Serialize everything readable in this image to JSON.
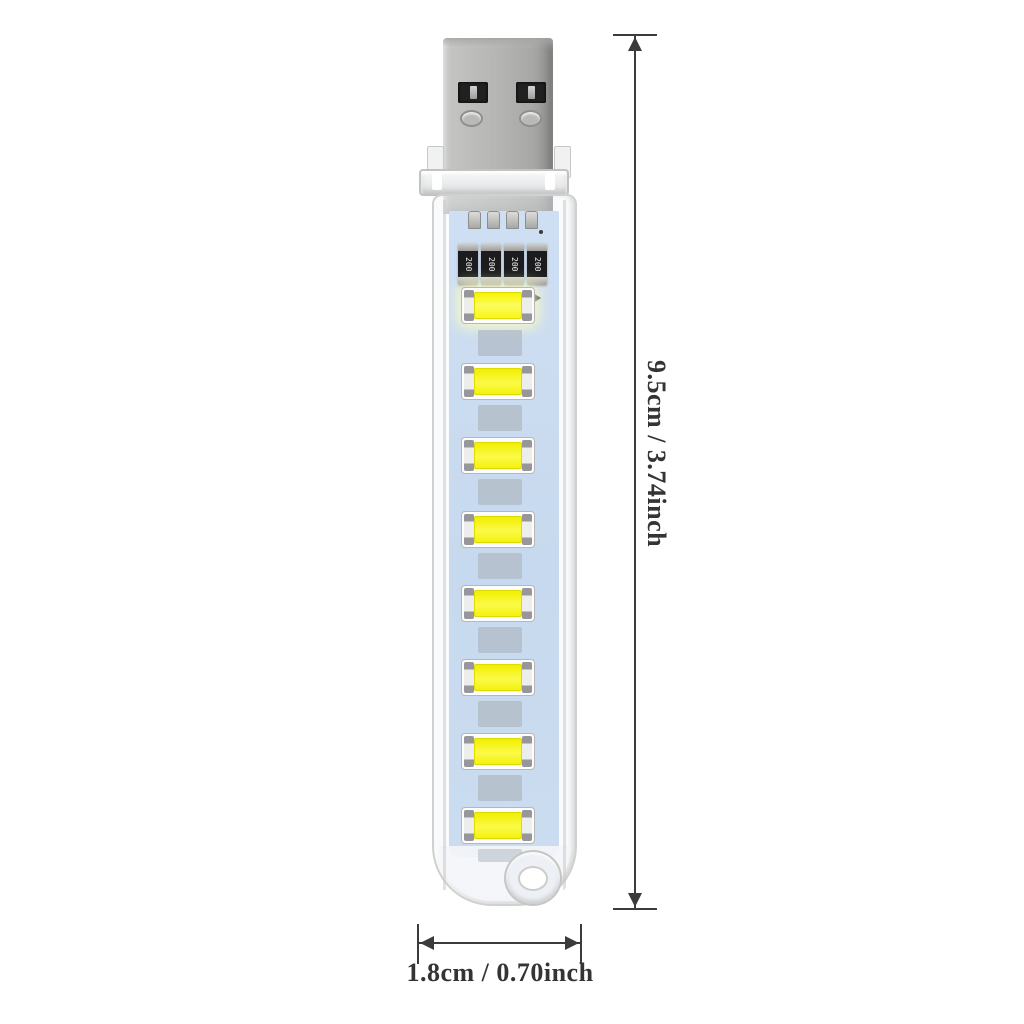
{
  "image": {
    "type": "product-photo",
    "subject": "USB LED light stick with dimension callouts",
    "background_color": "#ffffff"
  },
  "product": {
    "connector_type": "USB-A",
    "led_count": 8,
    "resistor_count": 4,
    "resistor_label": "200",
    "colors": {
      "metal_shell": "#b4b4b2",
      "metal_shell_shadow": "#8e8e8c",
      "connector_slot": "#212121",
      "clear_plastic": "#f1f3f5",
      "plastic_outline": "#d0d0ce",
      "pcb": "#cbdcf0",
      "led_package": "#fdfdfd",
      "led_emitter_yellow": "#f4f20e",
      "solder_pad": "#b0bac4"
    }
  },
  "annotations": {
    "height_label": "9.5cm / 3.74inch",
    "width_label": "1.8cm / 0.70inch",
    "line_color": "#3b3b3b",
    "text_color": "#343434"
  }
}
